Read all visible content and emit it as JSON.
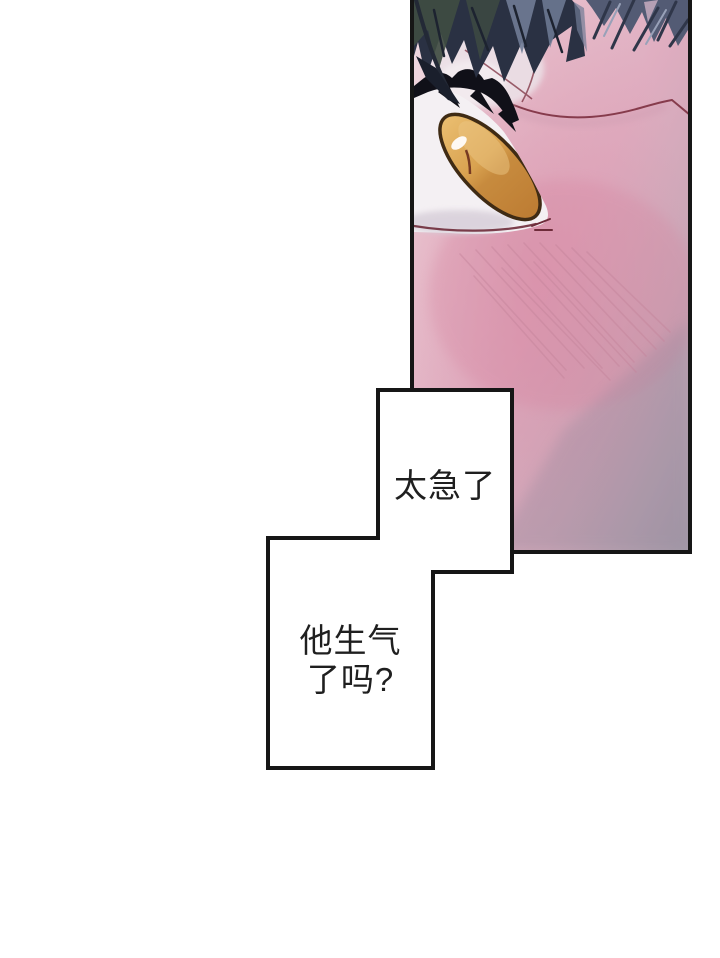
{
  "page": {
    "kind_label": "comic page",
    "background": "#ffffff"
  },
  "dialogue": {
    "thought_top": "太急了",
    "thought_bottom_line1": "他生气",
    "thought_bottom_line2": "了吗?",
    "thought_bottom_full": "他生气了吗?"
  },
  "palette": {
    "page-bg": "#ffffff",
    "ink": "#161616",
    "text": "#1f1f1f",
    "bubble-bg": "#ffffff",
    "skin-light": "#f0dde3",
    "skin-rose": "#dfadc0",
    "skin-blush": "#d88ca6",
    "skin-shadow-gray": "#a49aa8",
    "hair-dark": "#2a3143",
    "hair-slate": "#4d5770",
    "hair-highlight": "#707c96",
    "hair-green": "#3f4c42",
    "iris-gold": "#d9a250",
    "iris-amber": "#bd7c33",
    "iris-outline": "#3f2b14",
    "eye-white": "#f4f0f3",
    "line-maroon": "#7c2f3f"
  }
}
